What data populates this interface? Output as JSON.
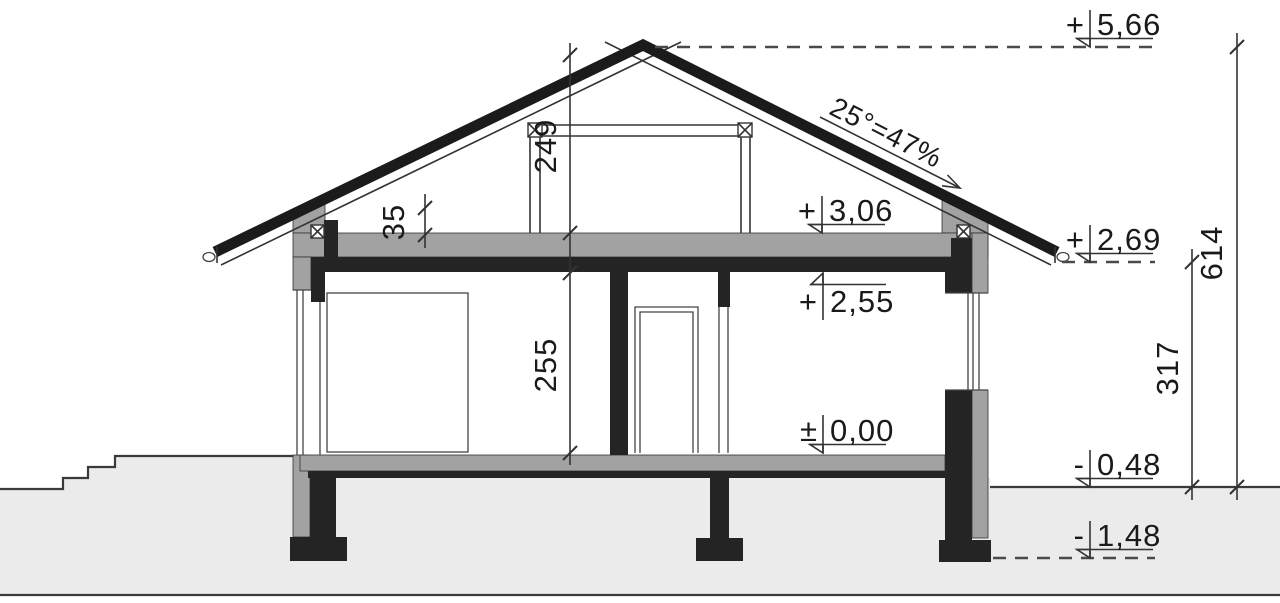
{
  "drawing": {
    "kind": "house-cross-section",
    "colors": {
      "structure_black": "#242424",
      "masonry_grey": "#a2a2a2",
      "ground_grey": "#ebebeb",
      "line": "#333333",
      "background": "#ffffff"
    }
  },
  "levels": {
    "ridge": {
      "sign": "+",
      "value": "5,66"
    },
    "attic_floor": {
      "sign": "+",
      "value": "3,06"
    },
    "eaves": {
      "sign": "+",
      "value": "2,69"
    },
    "ceiling": {
      "sign": "+",
      "value": "2,55"
    },
    "floor": {
      "sign": "±",
      "value": "0,00"
    },
    "ground": {
      "sign": "-",
      "value": "0,48"
    },
    "foundation": {
      "sign": "-",
      "value": "1,48"
    }
  },
  "dimensions": {
    "attic_height": "249",
    "room_height": "255",
    "knee_wall_height": "35",
    "eaves_above_ground": "317",
    "ridge_above_ground": "614"
  },
  "roof": {
    "slope": "25°=47%"
  }
}
